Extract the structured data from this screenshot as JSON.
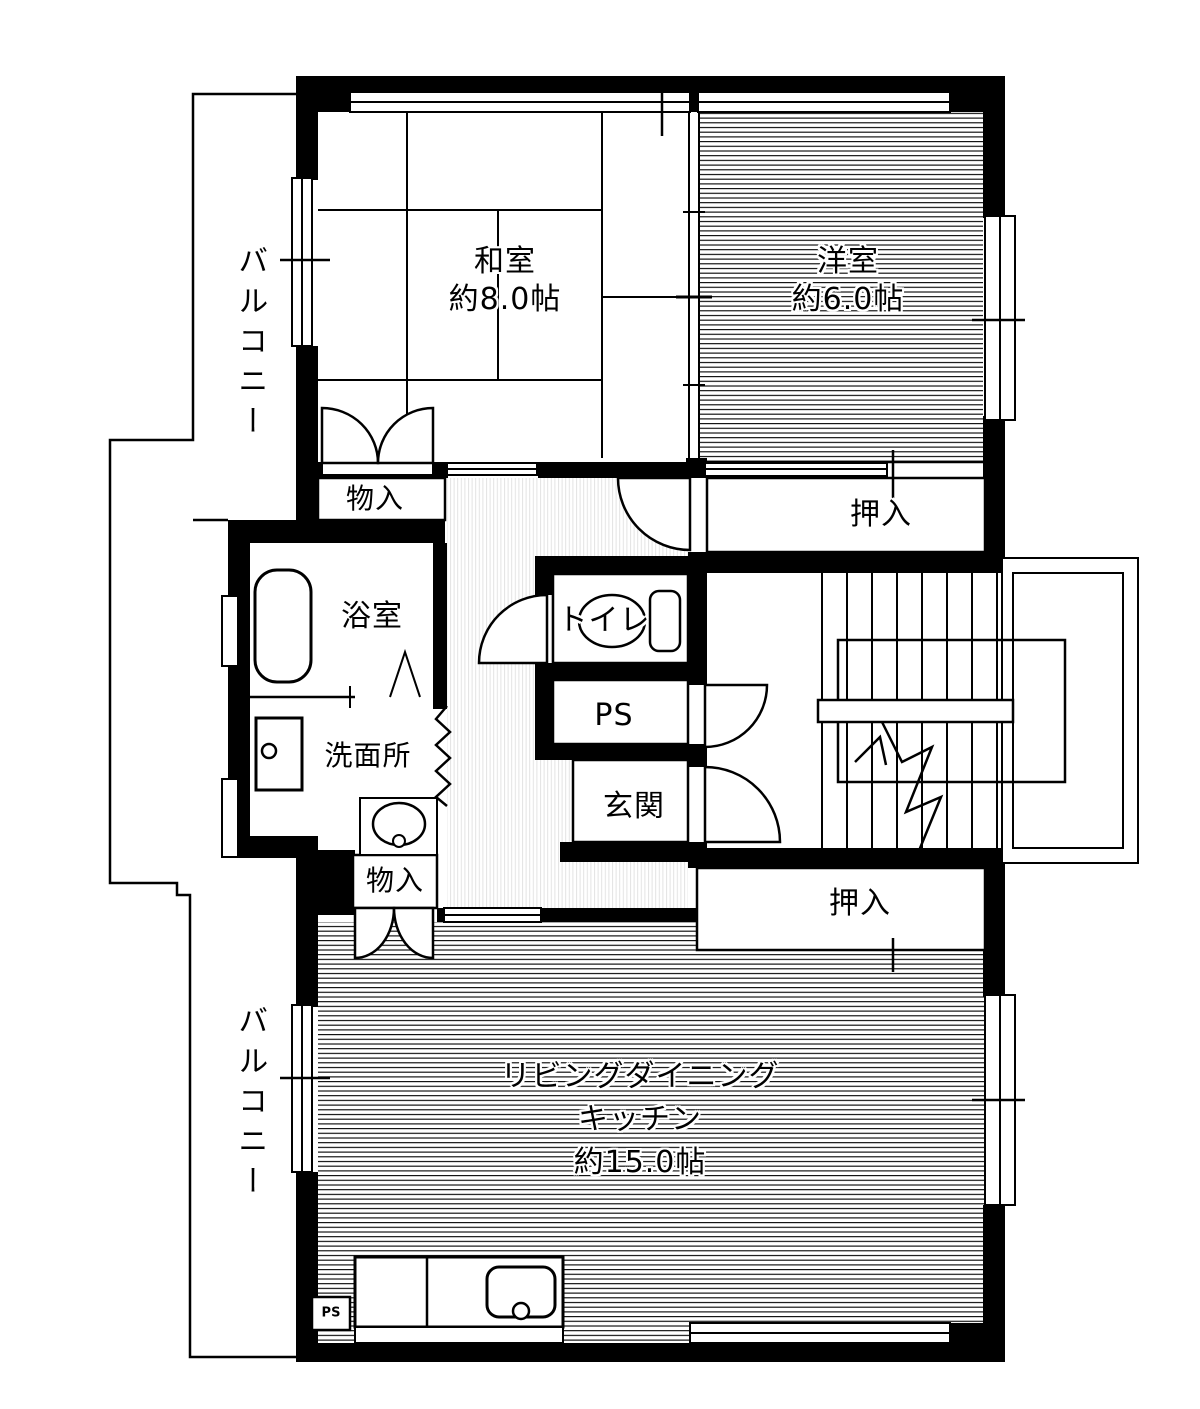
{
  "plan_type": "floor-plan",
  "colors": {
    "wall": "#000000",
    "background": "#ffffff"
  },
  "rooms": {
    "washitsu": {
      "name": "和室",
      "area": "約8.0帖"
    },
    "yoshitsu": {
      "name": "洋室",
      "area": "約6.0帖"
    },
    "ldk": {
      "name_line1": "リビングダイニング",
      "name_line2": "キッチン",
      "area": "約15.0帖"
    },
    "balcony_top": {
      "name": "バルコニー"
    },
    "balcony_bottom": {
      "name": "バルコニー"
    },
    "monoire_top": {
      "name": "物入"
    },
    "monoire_bottom": {
      "name": "物入"
    },
    "oshiire_top": {
      "name": "押入"
    },
    "oshiire_bottom": {
      "name": "押入"
    },
    "yokushitsu": {
      "name": "浴室"
    },
    "senmenjo": {
      "name": "洗面所"
    },
    "toilet": {
      "name": "トイレ"
    },
    "pipe_space": {
      "name": "PS"
    },
    "pipe_space_small": {
      "name": "PS"
    },
    "genkan": {
      "name": "玄関"
    }
  }
}
